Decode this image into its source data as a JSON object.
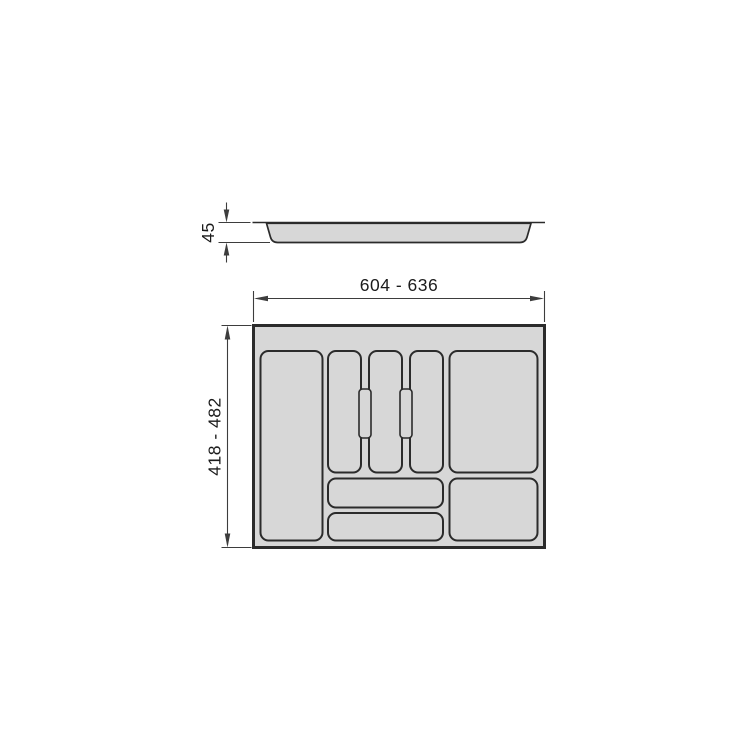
{
  "page": {
    "background": "#ffffff",
    "description": "Technical dimensional drawing of a cutlery tray insert for drawers"
  },
  "drawing": {
    "colors": {
      "tray_fill": "#d7d7d7",
      "outline": "#2b2b2b",
      "dimension_line": "#3d3d3d",
      "text": "#1b1b1b"
    },
    "side_view": {
      "name": "tray side profile",
      "height_label": "45"
    },
    "top_view": {
      "name": "tray top view",
      "width_label": "604 - 636",
      "depth_label": "418 - 482",
      "compartment_count": 8,
      "divider_pill_count": 2
    }
  }
}
